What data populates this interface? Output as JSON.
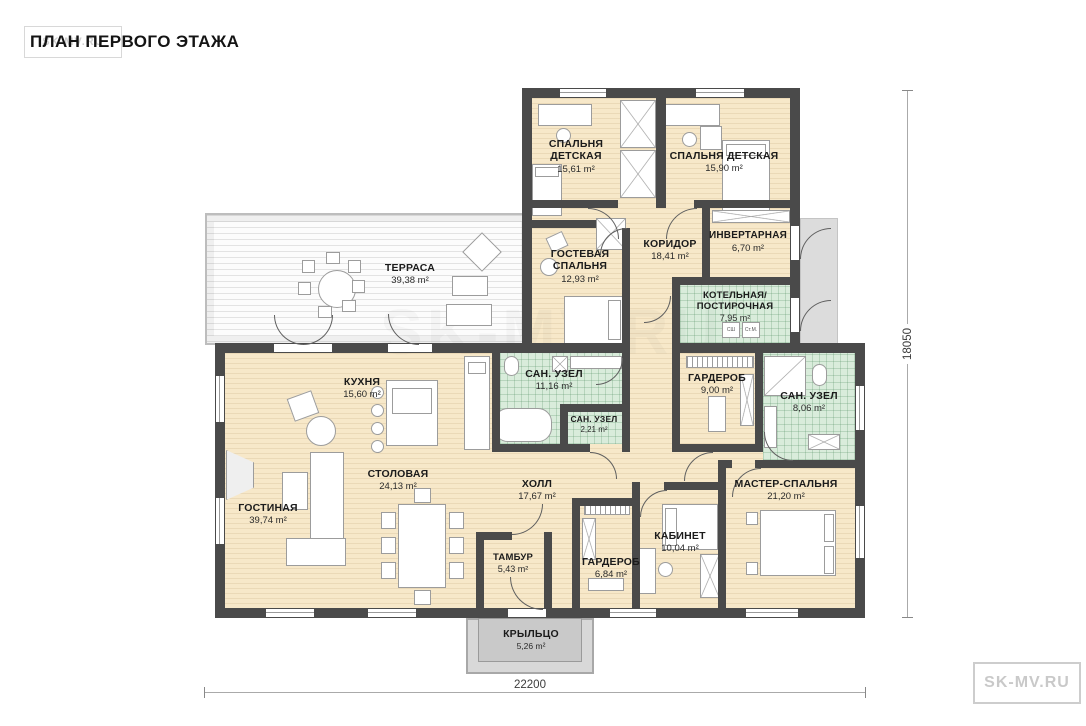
{
  "title": "ПЛАН ПЕРВОГО ЭТАЖА",
  "watermark": {
    "text": "SK-MV.RU"
  },
  "dimensions": {
    "width": "22200",
    "height": "18050"
  },
  "appliances": {
    "box1": "СШ",
    "box2": "Ст.М."
  },
  "rooms": [
    {
      "name": "СПАЛЬНЯ ДЕТСКАЯ",
      "area": "15,61 m²"
    },
    {
      "name": "СПАЛЬНЯ ДЕТСКАЯ",
      "area": "15,90 m²"
    },
    {
      "name": "КОРИДОР",
      "area": "18,41 m²"
    },
    {
      "name": "ИНВЕРТАРНАЯ",
      "area": "6,70 m²"
    },
    {
      "name": "ГОСТЕВАЯ СПАЛЬНЯ",
      "area": "12,93 m²"
    },
    {
      "name": "ТЕРРАСА",
      "area": "39,38 m²"
    },
    {
      "name": "КОТЕЛЬНАЯ/\nПОСТИРОЧНАЯ",
      "area": "7,95 m²"
    },
    {
      "name": "КУХНЯ",
      "area": "15,60 m²"
    },
    {
      "name": "САН. УЗЕЛ",
      "area": "11,16 m²"
    },
    {
      "name": "ГАРДЕРОБ",
      "area": "9,00 m²"
    },
    {
      "name": "САН. УЗЕЛ",
      "area": "8,06 m²"
    },
    {
      "name": "САН. УЗЕЛ",
      "area": "2,21 m²"
    },
    {
      "name": "ГОСТИНАЯ",
      "area": "39,74 m²"
    },
    {
      "name": "СТОЛОВАЯ",
      "area": "24,13 m²"
    },
    {
      "name": "ХОЛЛ",
      "area": "17,67 m²"
    },
    {
      "name": "МАСТЕР-СПАЛЬНЯ",
      "area": "21,20 m²"
    },
    {
      "name": "КАБИНЕТ",
      "area": "10,04 m²"
    },
    {
      "name": "ТАМБУР",
      "area": "5,43 m²"
    },
    {
      "name": "ГАРДЕРОБ",
      "area": "6,84 m²"
    },
    {
      "name": "КРЫЛЬЦО",
      "area": "5,26 m²"
    }
  ]
}
